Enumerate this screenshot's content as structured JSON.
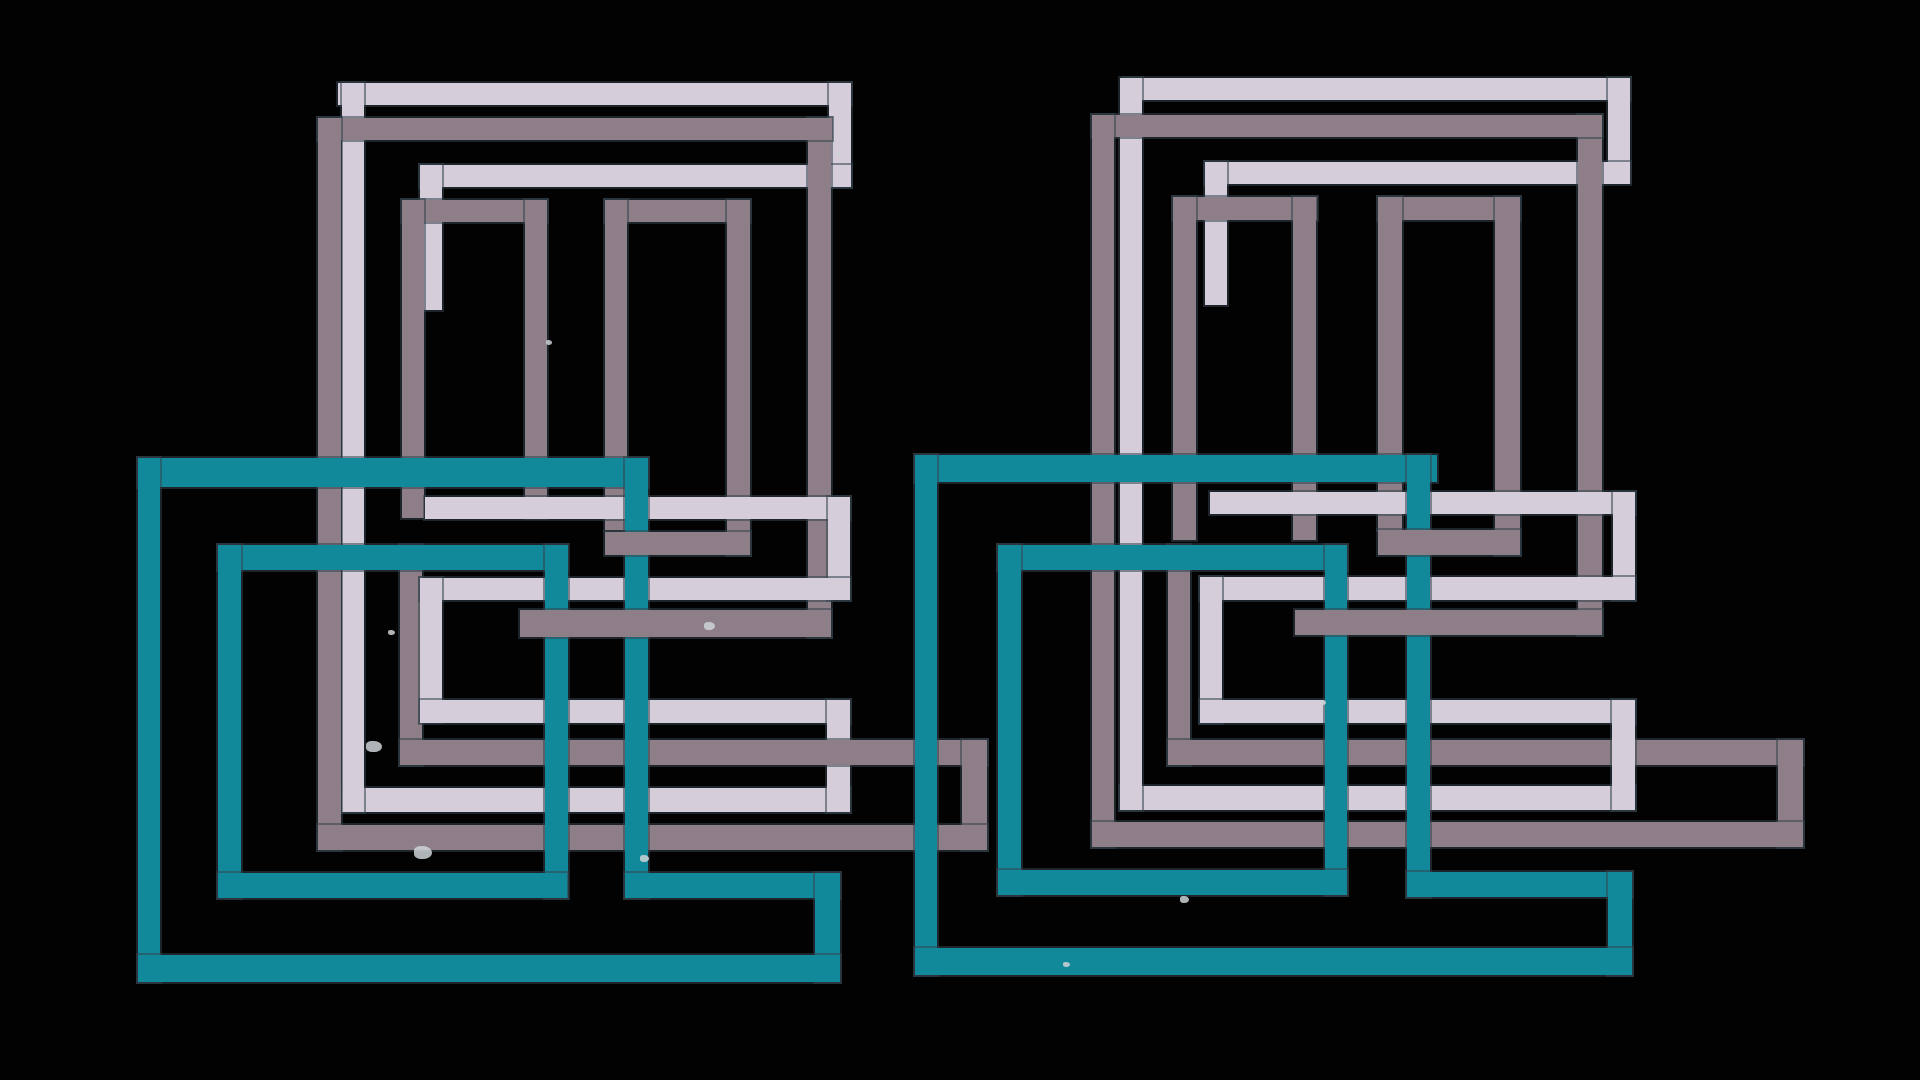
{
  "artwork": {
    "description": "abstract-geometric-overlapping-rectangles",
    "background": "#020203"
  },
  "colors": {
    "lavender": "#d6cddb",
    "mauve": "#8d7e88",
    "teal": "#12899b",
    "speck": "#cdd3d6"
  },
  "bars": [
    {
      "name": "left-lavender-outer-top",
      "color": "lavender",
      "x": 338,
      "y": 83,
      "w": 513,
      "h": 22,
      "z": 10
    },
    {
      "name": "left-lavender-outer-right-leg",
      "color": "lavender",
      "x": 829,
      "y": 83,
      "w": 22,
      "h": 104,
      "z": 10
    },
    {
      "name": "left-lavender-outer-left",
      "color": "lavender",
      "x": 342,
      "y": 83,
      "w": 22,
      "h": 729,
      "z": 12
    },
    {
      "name": "left-lavender-second-top",
      "color": "lavender",
      "x": 420,
      "y": 165,
      "w": 431,
      "h": 22,
      "z": 10
    },
    {
      "name": "left-lavender-second-leg",
      "color": "lavender",
      "x": 420,
      "y": 165,
      "w": 22,
      "h": 145,
      "z": 10
    },
    {
      "name": "left-lavender-mid-band-1",
      "color": "lavender",
      "x": 425,
      "y": 497,
      "w": 425,
      "h": 22,
      "z": 25
    },
    {
      "name": "left-lavender-mid-v-1",
      "color": "lavender",
      "x": 828,
      "y": 497,
      "w": 22,
      "h": 103,
      "z": 25
    },
    {
      "name": "left-lavender-mid-band-2",
      "color": "lavender",
      "x": 420,
      "y": 578,
      "w": 430,
      "h": 22,
      "z": 25
    },
    {
      "name": "left-lavender-mid-v-2",
      "color": "lavender",
      "x": 420,
      "y": 578,
      "w": 22,
      "h": 144,
      "z": 25
    },
    {
      "name": "left-lavender-mid-band-3",
      "color": "lavender",
      "x": 420,
      "y": 700,
      "w": 430,
      "h": 23,
      "z": 25
    },
    {
      "name": "left-lavender-mid-v-3",
      "color": "lavender",
      "x": 827,
      "y": 700,
      "w": 23,
      "h": 112,
      "z": 25
    },
    {
      "name": "left-lavender-bottom-band",
      "color": "lavender",
      "x": 342,
      "y": 788,
      "w": 508,
      "h": 24,
      "z": 10
    },
    {
      "name": "left-mauve-outer-top",
      "color": "mauve",
      "x": 318,
      "y": 118,
      "w": 514,
      "h": 22,
      "z": 20
    },
    {
      "name": "left-mauve-outer-right",
      "color": "mauve",
      "x": 808,
      "y": 118,
      "w": 23,
      "h": 519,
      "z": 18
    },
    {
      "name": "left-mauve-outer-left",
      "color": "mauve",
      "x": 318,
      "y": 118,
      "w": 23,
      "h": 732,
      "z": 20
    },
    {
      "name": "left-mauve-ring-bottom",
      "color": "mauve",
      "x": 520,
      "y": 610,
      "w": 311,
      "h": 27,
      "z": 35
    },
    {
      "name": "left-mauve-door1-top",
      "color": "mauve",
      "x": 402,
      "y": 200,
      "w": 145,
      "h": 22,
      "z": 20
    },
    {
      "name": "left-mauve-door1-left",
      "color": "mauve",
      "x": 402,
      "y": 200,
      "w": 22,
      "h": 318,
      "z": 20
    },
    {
      "name": "left-mauve-door1-right",
      "color": "mauve",
      "x": 525,
      "y": 200,
      "w": 22,
      "h": 318,
      "z": 20
    },
    {
      "name": "left-mauve-door2-top",
      "color": "mauve",
      "x": 605,
      "y": 200,
      "w": 145,
      "h": 22,
      "z": 20
    },
    {
      "name": "left-mauve-door2-left",
      "color": "mauve",
      "x": 605,
      "y": 200,
      "w": 22,
      "h": 330,
      "z": 20
    },
    {
      "name": "left-mauve-door2-right",
      "color": "mauve",
      "x": 727,
      "y": 200,
      "w": 23,
      "h": 355,
      "z": 20
    },
    {
      "name": "left-mauve-door2-bottom",
      "color": "mauve",
      "x": 605,
      "y": 532,
      "w": 145,
      "h": 23,
      "z": 35
    },
    {
      "name": "left-mauve-hook-v1",
      "color": "mauve",
      "x": 400,
      "y": 545,
      "w": 22,
      "h": 220,
      "z": 20
    },
    {
      "name": "left-mauve-hook-h1",
      "color": "mauve",
      "x": 400,
      "y": 740,
      "w": 587,
      "h": 25,
      "z": 28
    },
    {
      "name": "left-mauve-hook-v2",
      "color": "mauve",
      "x": 962,
      "y": 740,
      "w": 25,
      "h": 110,
      "z": 28
    },
    {
      "name": "left-mauve-hook-h2",
      "color": "mauve",
      "x": 318,
      "y": 825,
      "w": 669,
      "h": 25,
      "z": 28
    },
    {
      "name": "left-teal-outer-top",
      "color": "teal",
      "x": 138,
      "y": 458,
      "w": 510,
      "h": 29,
      "z": 30
    },
    {
      "name": "left-teal-outer-left",
      "color": "teal",
      "x": 138,
      "y": 458,
      "w": 22,
      "h": 524,
      "z": 30
    },
    {
      "name": "left-teal-outer-right",
      "color": "teal",
      "x": 625,
      "y": 458,
      "w": 23,
      "h": 440,
      "z": 30
    },
    {
      "name": "left-teal-step-h",
      "color": "teal",
      "x": 625,
      "y": 873,
      "w": 215,
      "h": 25,
      "z": 30
    },
    {
      "name": "left-teal-step-v",
      "color": "teal",
      "x": 815,
      "y": 873,
      "w": 25,
      "h": 109,
      "z": 30
    },
    {
      "name": "left-teal-outer-bottom",
      "color": "teal",
      "x": 138,
      "y": 955,
      "w": 702,
      "h": 27,
      "z": 30
    },
    {
      "name": "left-teal-inner-top",
      "color": "teal",
      "x": 218,
      "y": 545,
      "w": 349,
      "h": 25,
      "z": 30
    },
    {
      "name": "left-teal-inner-left",
      "color": "teal",
      "x": 218,
      "y": 545,
      "w": 23,
      "h": 353,
      "z": 30
    },
    {
      "name": "left-teal-inner-right",
      "color": "teal",
      "x": 545,
      "y": 545,
      "w": 23,
      "h": 353,
      "z": 30
    },
    {
      "name": "left-teal-inner-bottom",
      "color": "teal",
      "x": 218,
      "y": 873,
      "w": 349,
      "h": 25,
      "z": 30
    },
    {
      "name": "right-lavender-outer-top",
      "color": "lavender",
      "x": 1123,
      "y": 78,
      "w": 507,
      "h": 22,
      "z": 10
    },
    {
      "name": "right-lavender-outer-right-leg",
      "color": "lavender",
      "x": 1608,
      "y": 78,
      "w": 22,
      "h": 104,
      "z": 10
    },
    {
      "name": "right-lavender-outer-left",
      "color": "lavender",
      "x": 1120,
      "y": 78,
      "w": 22,
      "h": 732,
      "z": 12
    },
    {
      "name": "right-lavender-second-top",
      "color": "lavender",
      "x": 1205,
      "y": 162,
      "w": 425,
      "h": 22,
      "z": 10
    },
    {
      "name": "right-lavender-second-leg",
      "color": "lavender",
      "x": 1205,
      "y": 162,
      "w": 22,
      "h": 143,
      "z": 10
    },
    {
      "name": "right-lavender-mid-band-1",
      "color": "lavender",
      "x": 1210,
      "y": 492,
      "w": 425,
      "h": 22,
      "z": 25
    },
    {
      "name": "right-lavender-mid-v-1",
      "color": "lavender",
      "x": 1613,
      "y": 492,
      "w": 22,
      "h": 108,
      "z": 25
    },
    {
      "name": "right-lavender-mid-band-2",
      "color": "lavender",
      "x": 1200,
      "y": 577,
      "w": 435,
      "h": 23,
      "z": 25
    },
    {
      "name": "right-lavender-mid-v-2",
      "color": "lavender",
      "x": 1200,
      "y": 577,
      "w": 22,
      "h": 146,
      "z": 25
    },
    {
      "name": "right-lavender-mid-band-3",
      "color": "lavender",
      "x": 1200,
      "y": 700,
      "w": 435,
      "h": 23,
      "z": 25
    },
    {
      "name": "right-lavender-mid-v-3",
      "color": "lavender",
      "x": 1612,
      "y": 700,
      "w": 23,
      "h": 110,
      "z": 25
    },
    {
      "name": "right-lavender-bottom-band",
      "color": "lavender",
      "x": 1120,
      "y": 786,
      "w": 515,
      "h": 24,
      "z": 10
    },
    {
      "name": "right-mauve-outer-top",
      "color": "mauve",
      "x": 1092,
      "y": 115,
      "w": 510,
      "h": 22,
      "z": 20
    },
    {
      "name": "right-mauve-outer-right",
      "color": "mauve",
      "x": 1578,
      "y": 115,
      "w": 24,
      "h": 520,
      "z": 18
    },
    {
      "name": "right-mauve-outer-left",
      "color": "mauve",
      "x": 1092,
      "y": 115,
      "w": 22,
      "h": 732,
      "z": 20
    },
    {
      "name": "right-mauve-ring-bottom",
      "color": "mauve",
      "x": 1295,
      "y": 610,
      "w": 307,
      "h": 25,
      "z": 35
    },
    {
      "name": "right-mauve-door1-top",
      "color": "mauve",
      "x": 1173,
      "y": 197,
      "w": 144,
      "h": 23,
      "z": 20
    },
    {
      "name": "right-mauve-door1-left",
      "color": "mauve",
      "x": 1173,
      "y": 197,
      "w": 23,
      "h": 343,
      "z": 20
    },
    {
      "name": "right-mauve-door1-right",
      "color": "mauve",
      "x": 1293,
      "y": 197,
      "w": 23,
      "h": 343,
      "z": 20
    },
    {
      "name": "right-mauve-door2-top",
      "color": "mauve",
      "x": 1378,
      "y": 197,
      "w": 142,
      "h": 23,
      "z": 20
    },
    {
      "name": "right-mauve-door2-left",
      "color": "mauve",
      "x": 1378,
      "y": 197,
      "w": 24,
      "h": 333,
      "z": 20
    },
    {
      "name": "right-mauve-door2-right",
      "color": "mauve",
      "x": 1495,
      "y": 197,
      "w": 25,
      "h": 358,
      "z": 20
    },
    {
      "name": "right-mauve-door2-bottom",
      "color": "mauve",
      "x": 1378,
      "y": 530,
      "w": 142,
      "h": 25,
      "z": 35
    },
    {
      "name": "right-mauve-hook-v1",
      "color": "mauve",
      "x": 1168,
      "y": 545,
      "w": 22,
      "h": 220,
      "z": 20
    },
    {
      "name": "right-mauve-hook-h1",
      "color": "mauve",
      "x": 1168,
      "y": 740,
      "w": 635,
      "h": 25,
      "z": 20
    },
    {
      "name": "right-mauve-hook-v2",
      "color": "mauve",
      "x": 1778,
      "y": 740,
      "w": 25,
      "h": 107,
      "z": 20
    },
    {
      "name": "right-mauve-hook-h2",
      "color": "mauve",
      "x": 1092,
      "y": 822,
      "w": 711,
      "h": 25,
      "z": 20
    },
    {
      "name": "right-teal-outer-top",
      "color": "teal",
      "x": 915,
      "y": 455,
      "w": 522,
      "h": 27,
      "z": 30
    },
    {
      "name": "right-teal-outer-left",
      "color": "teal",
      "x": 915,
      "y": 455,
      "w": 22,
      "h": 520,
      "z": 30
    },
    {
      "name": "right-teal-outer-right",
      "color": "teal",
      "x": 1407,
      "y": 455,
      "w": 23,
      "h": 442,
      "z": 30
    },
    {
      "name": "right-teal-step-h",
      "color": "teal",
      "x": 1407,
      "y": 872,
      "w": 225,
      "h": 25,
      "z": 30
    },
    {
      "name": "right-teal-step-v",
      "color": "teal",
      "x": 1608,
      "y": 872,
      "w": 24,
      "h": 103,
      "z": 30
    },
    {
      "name": "right-teal-outer-bottom",
      "color": "teal",
      "x": 915,
      "y": 948,
      "w": 717,
      "h": 27,
      "z": 30
    },
    {
      "name": "right-teal-inner-top",
      "color": "teal",
      "x": 998,
      "y": 545,
      "w": 349,
      "h": 25,
      "z": 30
    },
    {
      "name": "right-teal-inner-left",
      "color": "teal",
      "x": 998,
      "y": 545,
      "w": 23,
      "h": 350,
      "z": 30
    },
    {
      "name": "right-teal-inner-right",
      "color": "teal",
      "x": 1325,
      "y": 545,
      "w": 22,
      "h": 350,
      "z": 30
    },
    {
      "name": "right-teal-inner-bottom",
      "color": "teal",
      "x": 998,
      "y": 870,
      "w": 349,
      "h": 25,
      "z": 30
    }
  ],
  "speckles": [
    {
      "x": 366,
      "y": 741,
      "w": 16,
      "h": 11
    },
    {
      "x": 414,
      "y": 846,
      "w": 18,
      "h": 13
    },
    {
      "x": 640,
      "y": 855,
      "w": 9,
      "h": 7
    },
    {
      "x": 704,
      "y": 622,
      "w": 11,
      "h": 8
    },
    {
      "x": 388,
      "y": 630,
      "w": 7,
      "h": 5
    },
    {
      "x": 546,
      "y": 340,
      "w": 6,
      "h": 5
    },
    {
      "x": 1180,
      "y": 896,
      "w": 9,
      "h": 7
    },
    {
      "x": 1063,
      "y": 962,
      "w": 7,
      "h": 5
    },
    {
      "x": 1320,
      "y": 700,
      "w": 6,
      "h": 5
    },
    {
      "x": 836,
      "y": 152,
      "w": 5,
      "h": 4
    }
  ]
}
